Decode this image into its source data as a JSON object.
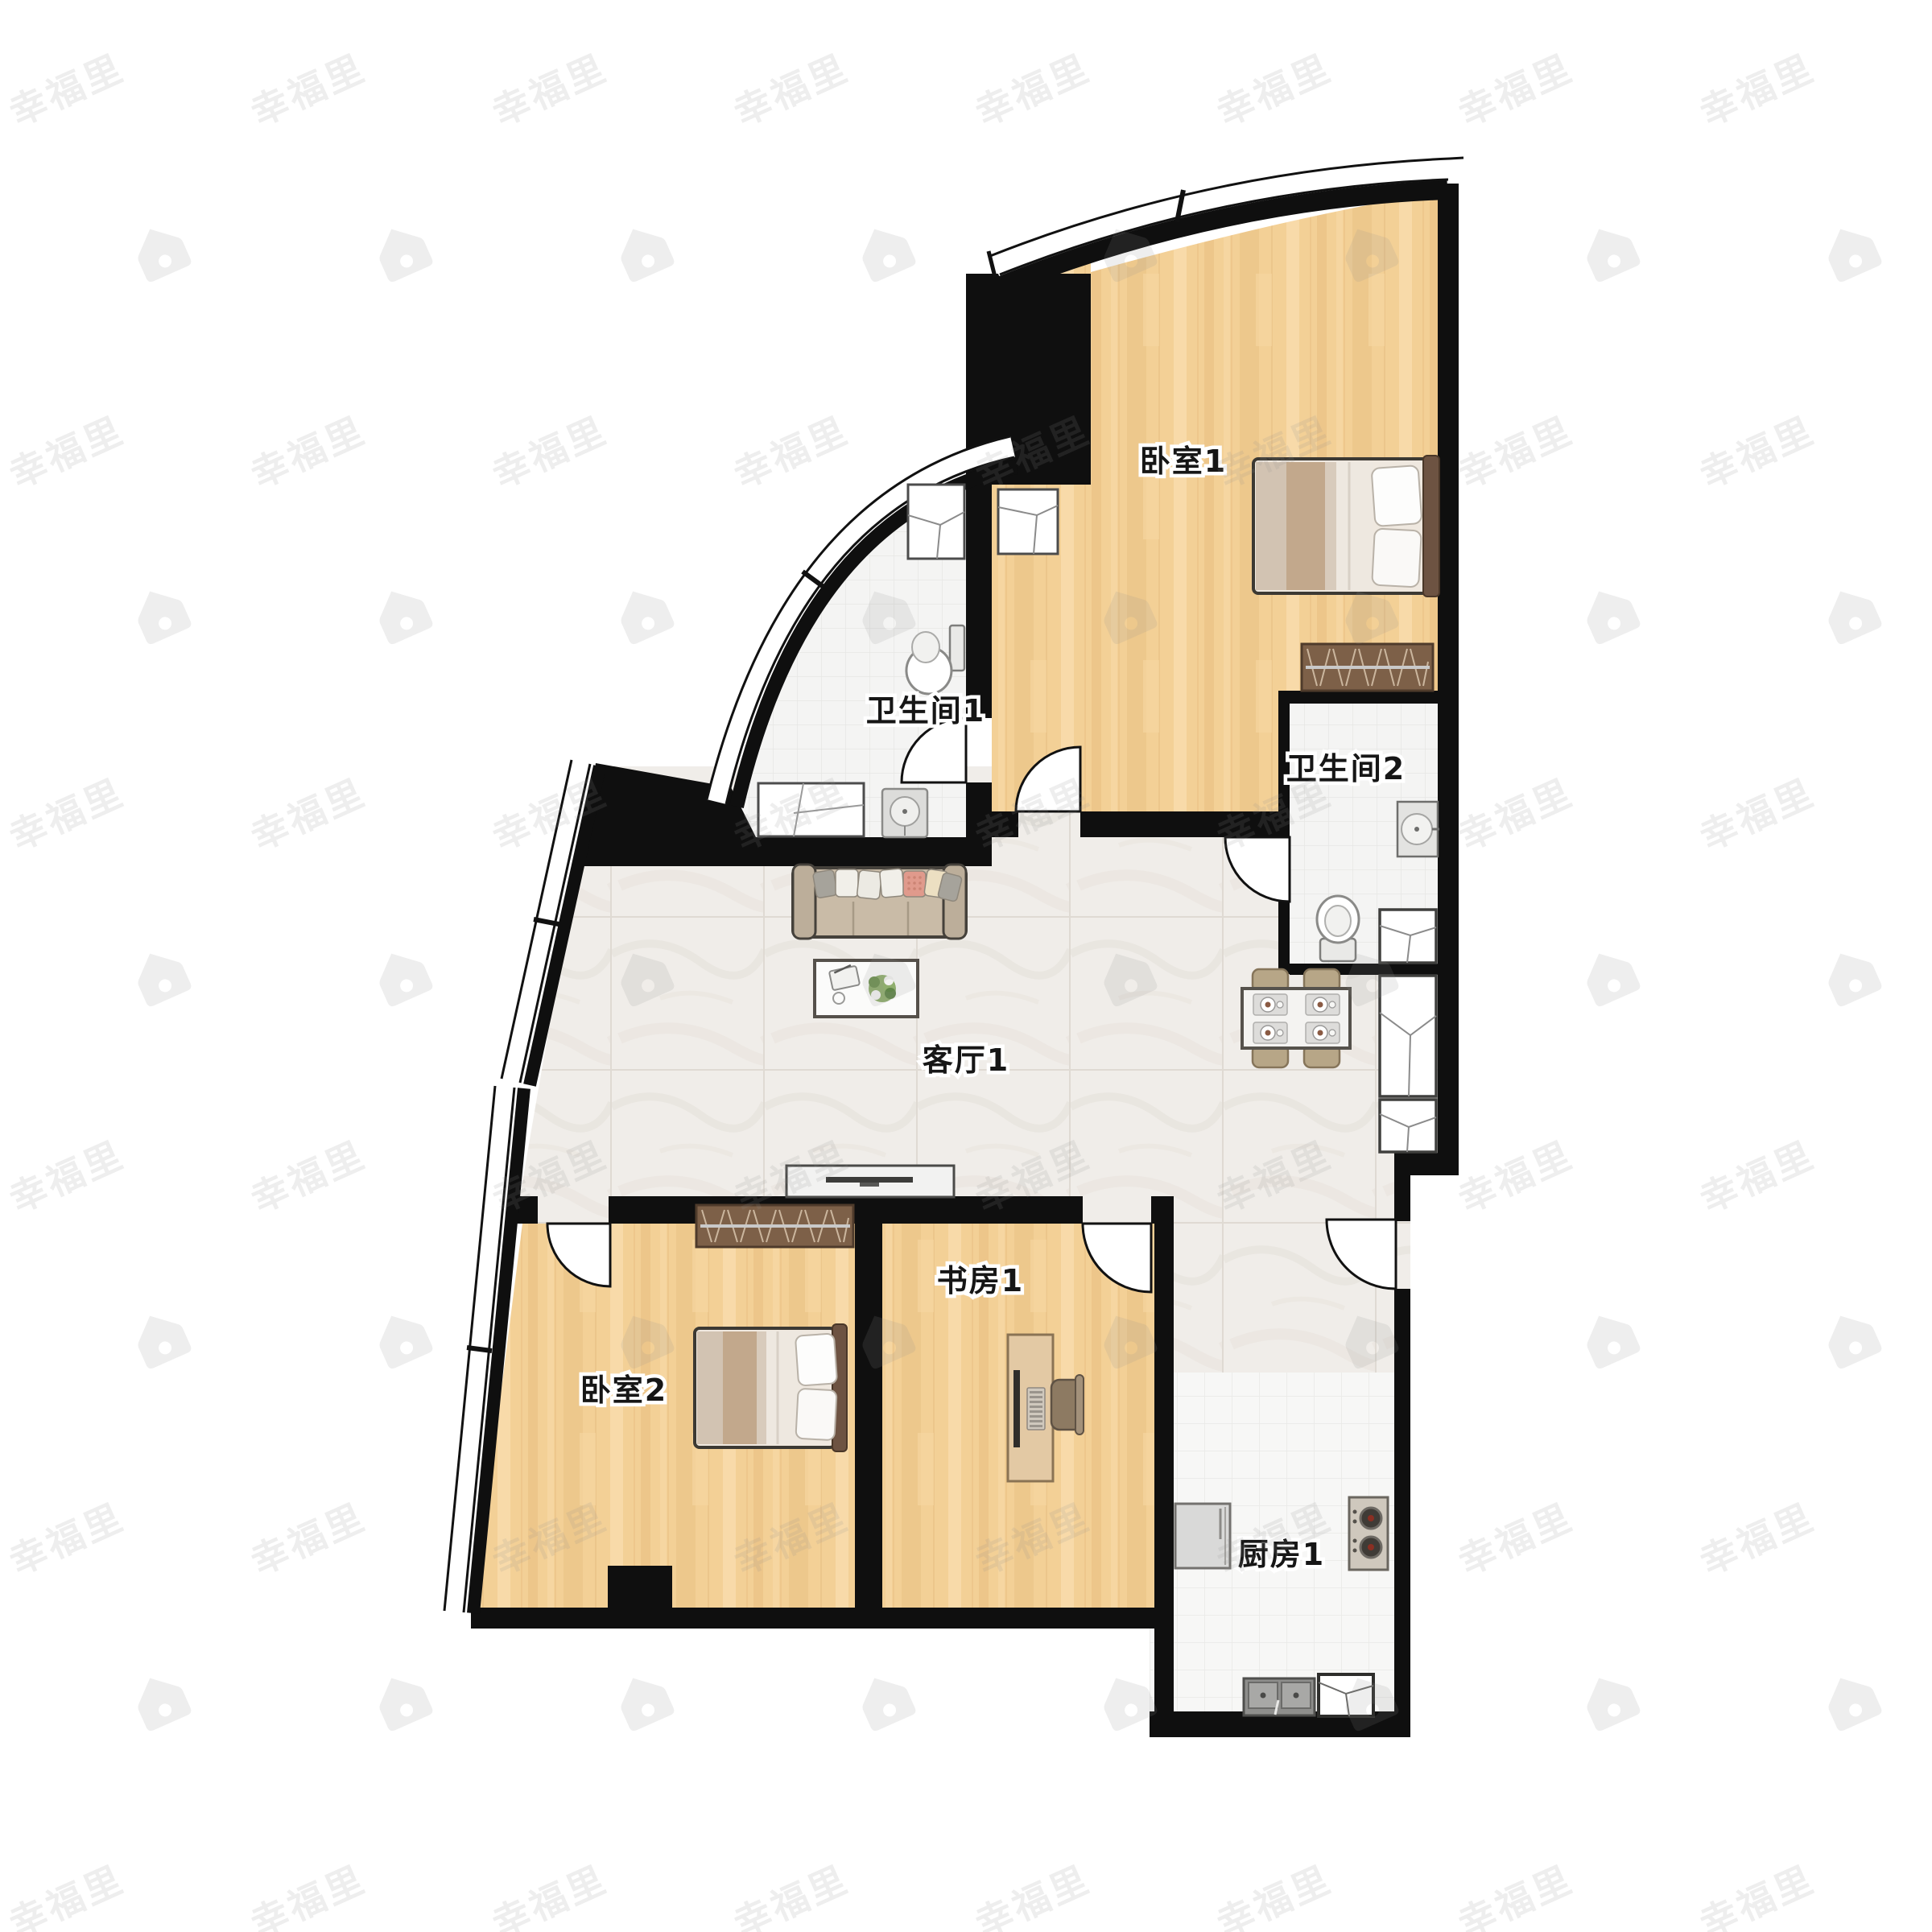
{
  "watermark": {
    "text": "幸福里",
    "icon": "house-icon",
    "color": "#8a8a8a",
    "opacity": 0.15
  },
  "rooms": {
    "bedroom1": {
      "label": "卧室1"
    },
    "bathroom1": {
      "label": "卫生间1"
    },
    "bathroom2": {
      "label": "卫生间2"
    },
    "living": {
      "label": "客厅1"
    },
    "bedroom2": {
      "label": "卧室2"
    },
    "study": {
      "label": "书房1"
    },
    "kitchen": {
      "label": "厨房1"
    }
  },
  "palette": {
    "wall": "#0f0f0f",
    "wood": "#f3d096",
    "wood_dark": "#e8bc7d",
    "marble": "#f0ede9",
    "tile": "#f4f4f3",
    "wardrobe": "#7d6048",
    "sofa": "#c9bba7",
    "headboard": "#6d5342",
    "blanket_tan": "#c2a88c",
    "pillow_coral": "#e09a8c",
    "chair_tan": "#b7a687"
  },
  "furniture": {
    "bedroom1": [
      "double-bed",
      "wardrobe",
      "dresser-cabinet"
    ],
    "bedroom2": [
      "double-bed",
      "wardrobe"
    ],
    "living": [
      "sofa",
      "coffee-table",
      "side-table",
      "tv-console",
      "dining-table",
      "dining-chairs"
    ],
    "bathroom1": [
      "toilet",
      "sink",
      "vanity-cabinet",
      "top-cabinet"
    ],
    "bathroom2": [
      "toilet",
      "sink",
      "shower-cabinet"
    ],
    "study": [
      "desk",
      "monitor",
      "office-chair"
    ],
    "kitchen": [
      "fridge",
      "gas-stove",
      "double-sink",
      "corner-cabinet"
    ],
    "hallway": [
      "storage-cabinet",
      "storage-cabinet"
    ]
  }
}
